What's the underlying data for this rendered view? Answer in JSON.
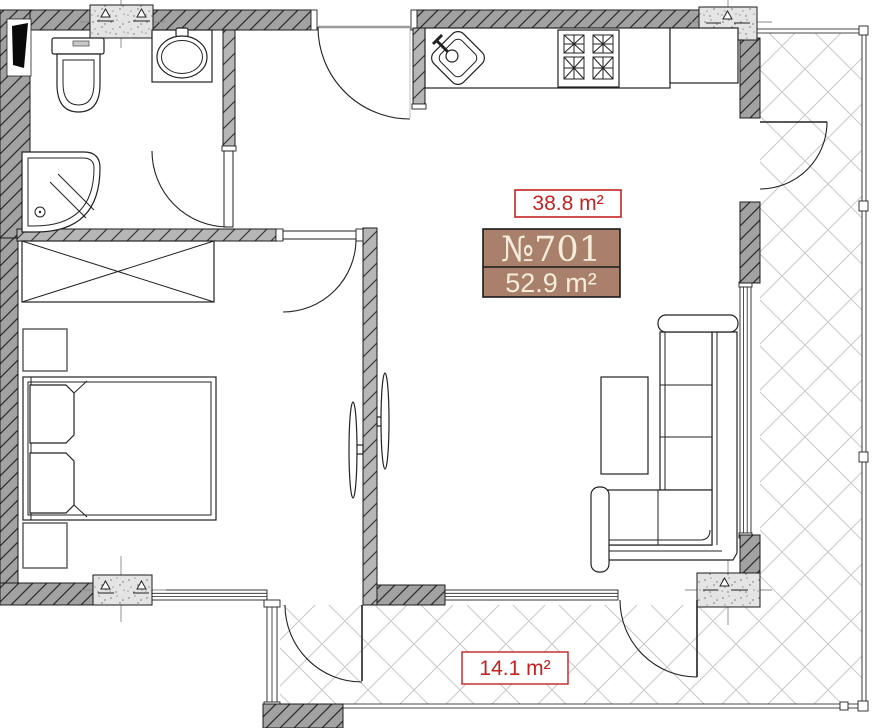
{
  "labels": {
    "living_area": "38.8 m²",
    "unit_number": "№701",
    "unit_total_area": "52.9 m²",
    "balcony_area": "14.1 m²"
  },
  "colors": {
    "area_label_red": "#c42222",
    "area_box_fill": "#ffffff",
    "unit_box_fill": "#a8806c",
    "unit_box_border": "#1a1a1a",
    "unit_box_text": "#f5ecd9",
    "wall_fill": "#a2a2a2",
    "interior_wall_fill": "#b6b6b6",
    "column_fill": "#e4e4e4",
    "balcony_hatch": "#c9c9c9",
    "outline": "#1b1b1b"
  },
  "fixtures": {
    "bathroom": [
      "toilet",
      "sink",
      "shower"
    ],
    "kitchen": [
      "kitchen-sink",
      "stove",
      "counter"
    ],
    "bedroom": [
      "wardrobe",
      "bed",
      "nightstand",
      "nightstand",
      "wall-tv"
    ],
    "living_room": [
      "corner-sofa",
      "coffee-table",
      "wall-tv"
    ],
    "balcony": [
      "railing",
      "glazing"
    ]
  }
}
